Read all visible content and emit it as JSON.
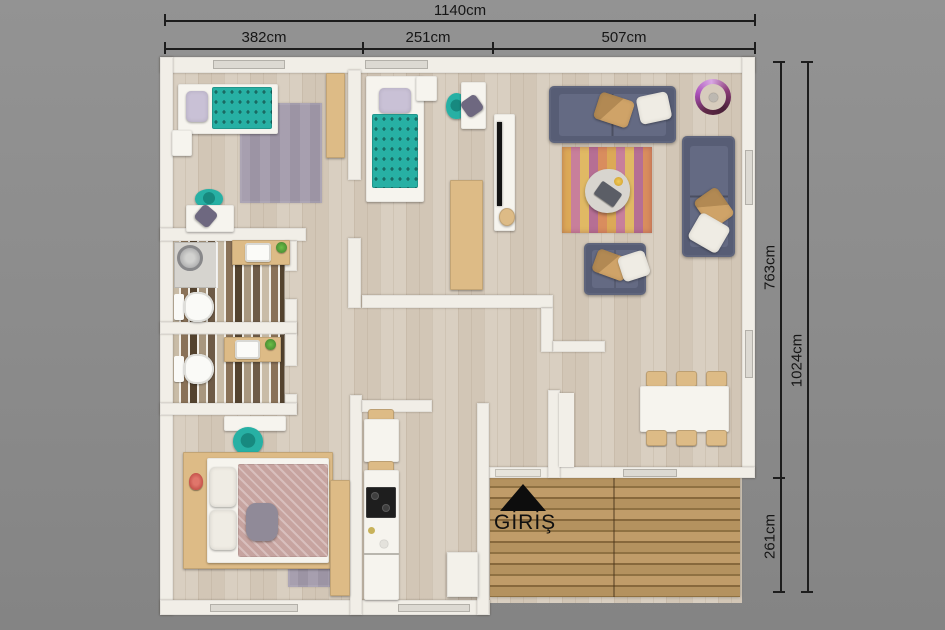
{
  "dimensions": {
    "total_width": "1140cm",
    "segments": [
      "382cm",
      "251cm",
      "507cm"
    ],
    "house_depth": "763cm",
    "total_depth": "1024cm",
    "porch_depth": "261cm"
  },
  "entrance": {
    "label": "GİRİŞ",
    "arrow_icon": "filled-up-triangle"
  },
  "colors": {
    "background": "#8c8c8c",
    "wall": "#f1eee7",
    "floor": "#d7ccbd",
    "teal": "#27b0a4",
    "sofa": "#575d75",
    "wood": "#ddbb86",
    "deck_wood": "#b08e5f",
    "rug_bedroom": "#a29aab",
    "rug_living_gold": "#dca957",
    "rug_living_pink": "#c87f9b",
    "bed_pink": "#c7a4a0",
    "lamp_purple": "#a94fb8",
    "dim": "#1d1d1d"
  }
}
